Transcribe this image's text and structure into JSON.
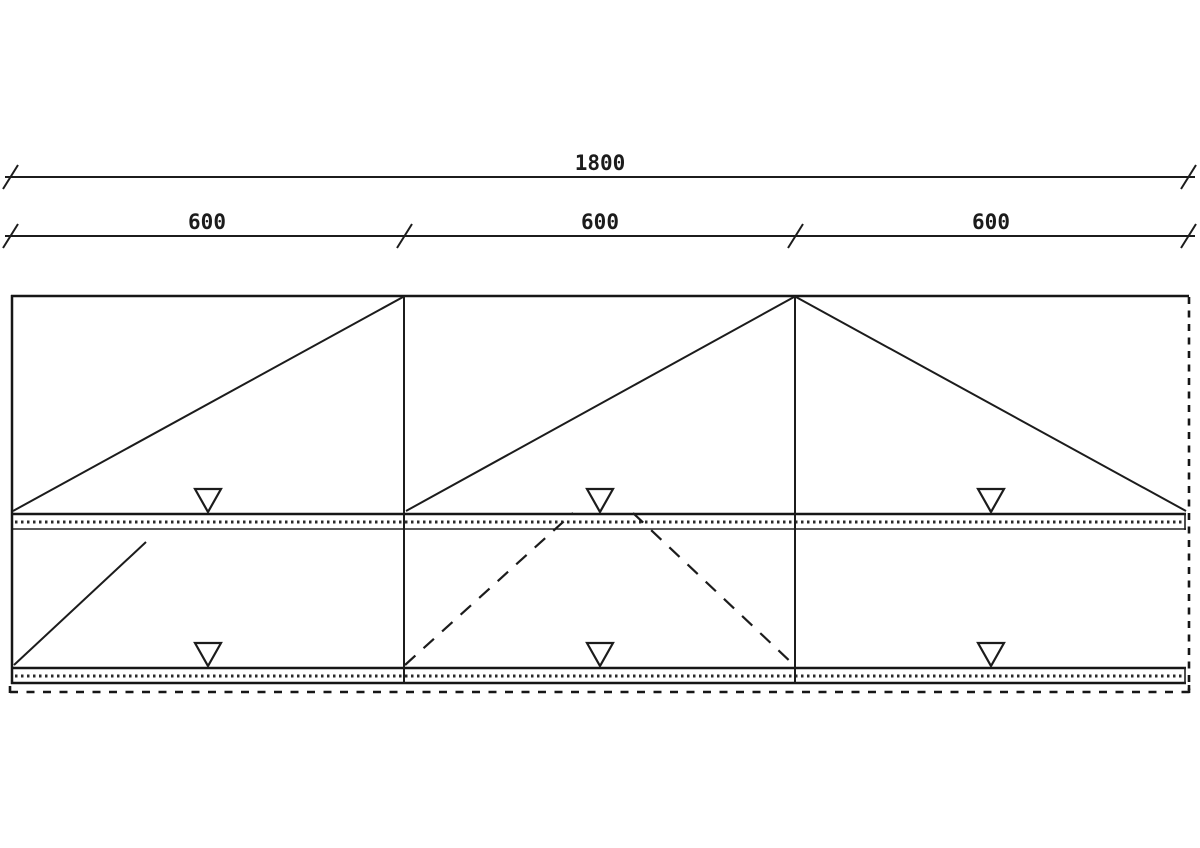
{
  "meta": {
    "background_color": "#ffffff",
    "line_color": "#1c1c1c"
  },
  "dimensions": {
    "overall": {
      "label": "1800"
    },
    "segments": [
      {
        "label": "600"
      },
      {
        "label": "600"
      },
      {
        "label": "600"
      }
    ]
  },
  "symbols": {
    "vent_marker": "triangle-down-open-icon",
    "dimension_tick": "slash-tick-icon",
    "opening_lines": "diagonal-sash-symbol",
    "section_outline": "dashed-line"
  }
}
